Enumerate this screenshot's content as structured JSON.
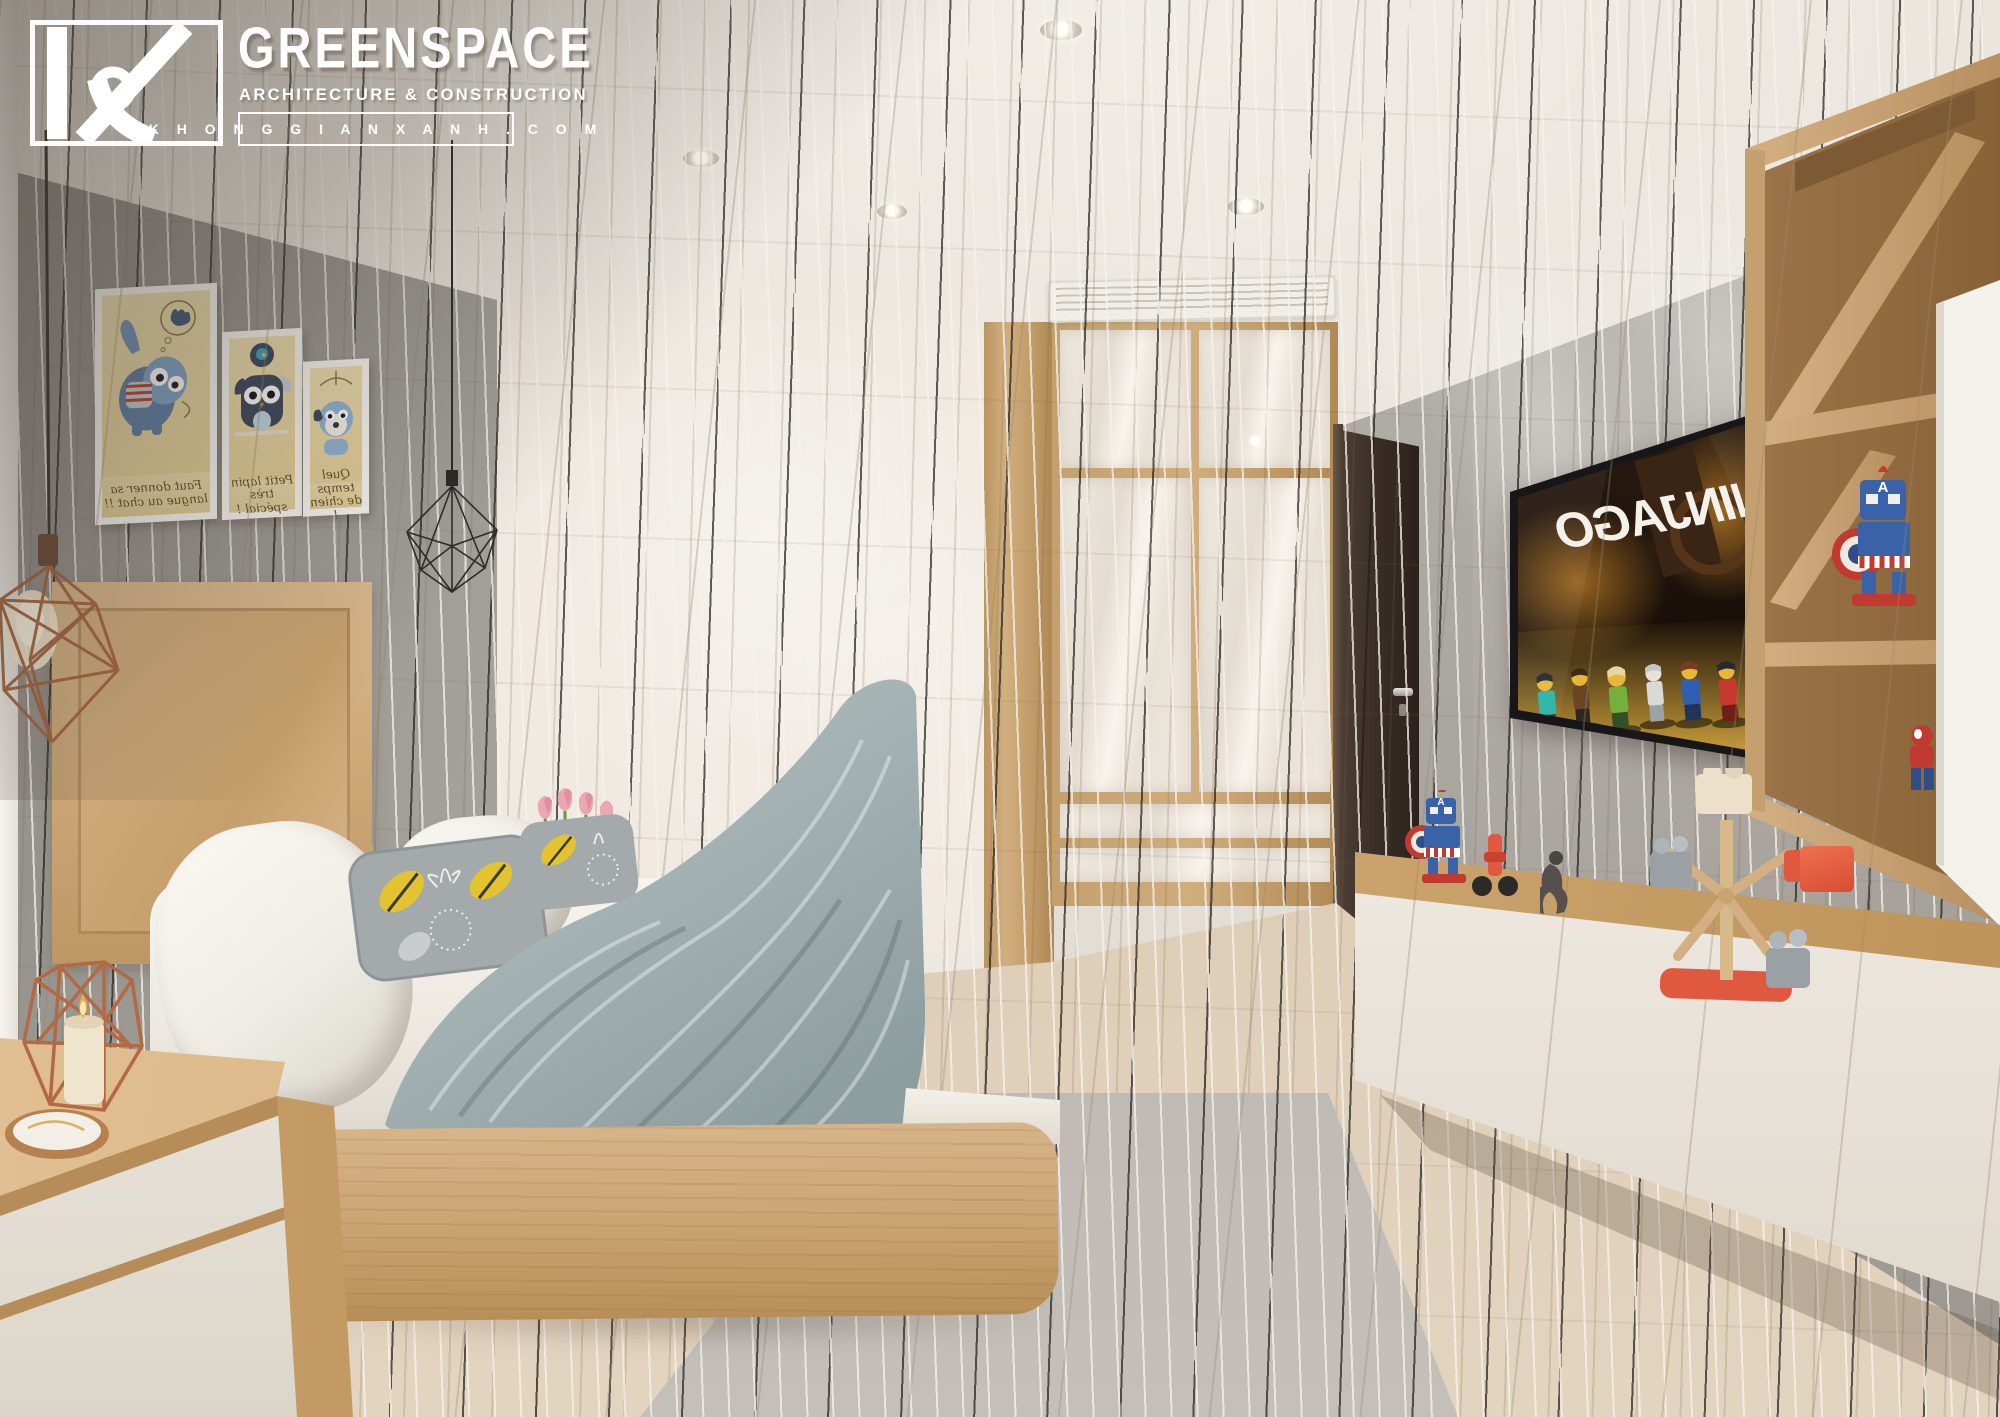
{
  "watermark": {
    "monogram": "KX",
    "brand": "GREENSPACE",
    "tagline": "ARCHITECTURE & CONSTRUCTION",
    "website": "K H O N G G I A N X A N H . C O M"
  },
  "tv": {
    "logo_text": "NINJAGO",
    "mirrored": true,
    "content": "LEGO Ninjago minifigure scene",
    "figure_count": 7
  },
  "wall_art": {
    "items": [
      {
        "subject": "blue cat with paw-print thought bubble",
        "caption": "Faut donner sa langue au chat !!",
        "mirrored": true
      },
      {
        "subject": "dark owl-rabbit plush",
        "caption": "Petit lapin très spécial !",
        "mirrored": true
      },
      {
        "subject": "blue dog under umbrella",
        "caption": "Quel temps de chien !",
        "mirrored": true
      }
    ]
  },
  "toys": {
    "captain_letter": "A",
    "items": [
      "captain-america-robot",
      "red-scooter",
      "dark-figurine",
      "wooden-ferris-wheel",
      "orange-block",
      "spiderman-figure"
    ]
  },
  "room": {
    "type": "kids bedroom interior render",
    "features": [
      "wall-art-frames",
      "pendant-wire-lamps",
      "double-bed",
      "nightstand-with-candle-lantern",
      "glossy-wardrobe",
      "ac-vent",
      "dark-door",
      "wall-tv",
      "floating-tv-console",
      "wood-shelving-unit",
      "striped-rug"
    ]
  },
  "palette": {
    "wood": "#cfab7c",
    "wood_floor": "#d8c8b1",
    "wall_gray": "#aaa7a1",
    "accent_wall": "#f0ebe3",
    "duvet": "#a9b5b6",
    "door": "#40332b",
    "copper": "#b26a45",
    "toy_red": "#e05840",
    "toy_blue": "#3a62a8",
    "rug": "#b7b2ac",
    "ninjago_glow": "#b97a24",
    "pillow_leaf_yellow": "#e3c430"
  }
}
